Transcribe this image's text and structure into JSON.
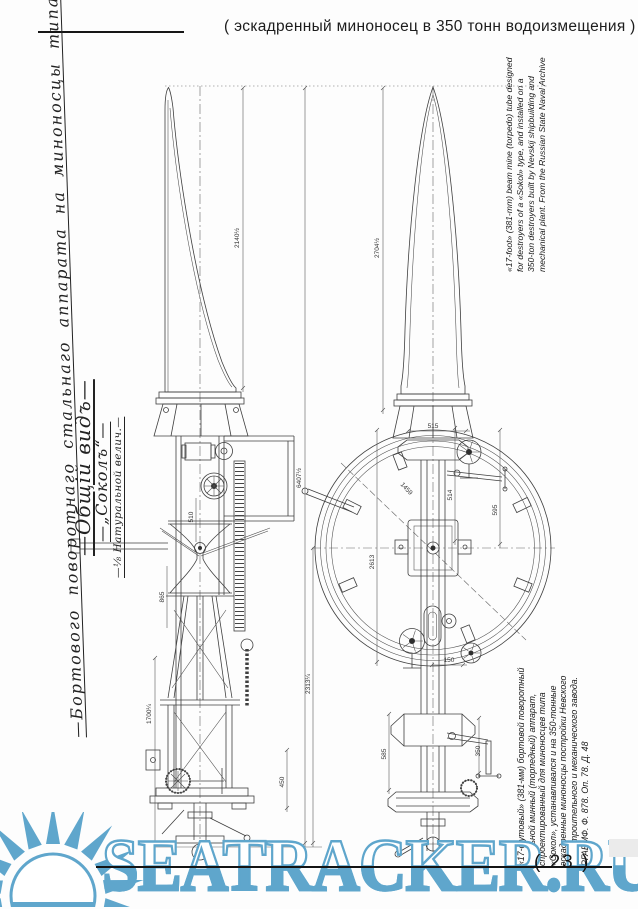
{
  "header": {
    "title": "( эскадренный миноносец в 350 тонн водоизмещения )"
  },
  "left_titles": {
    "main": "—Бортового поворотнаго стальнаго аппарата на миноносцы типа—",
    "view": "—Общій видъ—",
    "sokol": "—„Соколъ“—",
    "scale": "—⅛ Натуральной велич.—"
  },
  "side_captions": {
    "english_lines": [
      "«17-foot» (381-mm) beam mine (torpedo) tube designed",
      "for destroyers of a «Sokol» type, and installed on a",
      "350-ton destroyers built by Nevskij shipbuilding and",
      "mechanical plant. From the Russian State Naval Archive"
    ],
    "russian_lines": [
      "«17-футовый» (381-мм) бортовой поворотный",
      "стальной минный (торпедный) аппарат,",
      "спроектированный для миноносцев типа",
      "«Сокол», устанавливался и на 350-тонные",
      "эскадренные миноносцы постройки Невского",
      "судостроительного и механического завода.",
      "РГАВМФ. Ф. 878. Оп. 78. Д. 48"
    ]
  },
  "drawing": {
    "dimension_labels": [
      {
        "text": "2140½",
        "x": 239,
        "y": 238
      },
      {
        "text": "6407½",
        "x": 301,
        "y": 478
      },
      {
        "text": "2704½",
        "x": 379,
        "y": 248
      },
      {
        "text": "1700¼",
        "x": 151,
        "y": 714
      },
      {
        "text": "450",
        "x": 284,
        "y": 782
      },
      {
        "text": "595",
        "x": 497,
        "y": 510
      },
      {
        "text": "514",
        "x": 452,
        "y": 495
      },
      {
        "text": "515",
        "x": 433,
        "y": 428,
        "rotate": 0
      },
      {
        "text": "2613",
        "x": 374,
        "y": 562
      },
      {
        "text": "1459",
        "x": 405,
        "y": 490,
        "rotate": 47
      },
      {
        "text": "150",
        "x": 449,
        "y": 662,
        "rotate": 0
      },
      {
        "text": "2313¼",
        "x": 310,
        "y": 684
      },
      {
        "text": "510",
        "x": 193,
        "y": 517
      },
      {
        "text": "865",
        "x": 164,
        "y": 597
      },
      {
        "text": "350",
        "x": 480,
        "y": 751
      },
      {
        "text": "585",
        "x": 386,
        "y": 754
      }
    ]
  },
  "watermark": {
    "text": "SEATRACKER.RU",
    "color": "#5fa6cc"
  },
  "footer": {
    "page_number": "( 23 )"
  }
}
